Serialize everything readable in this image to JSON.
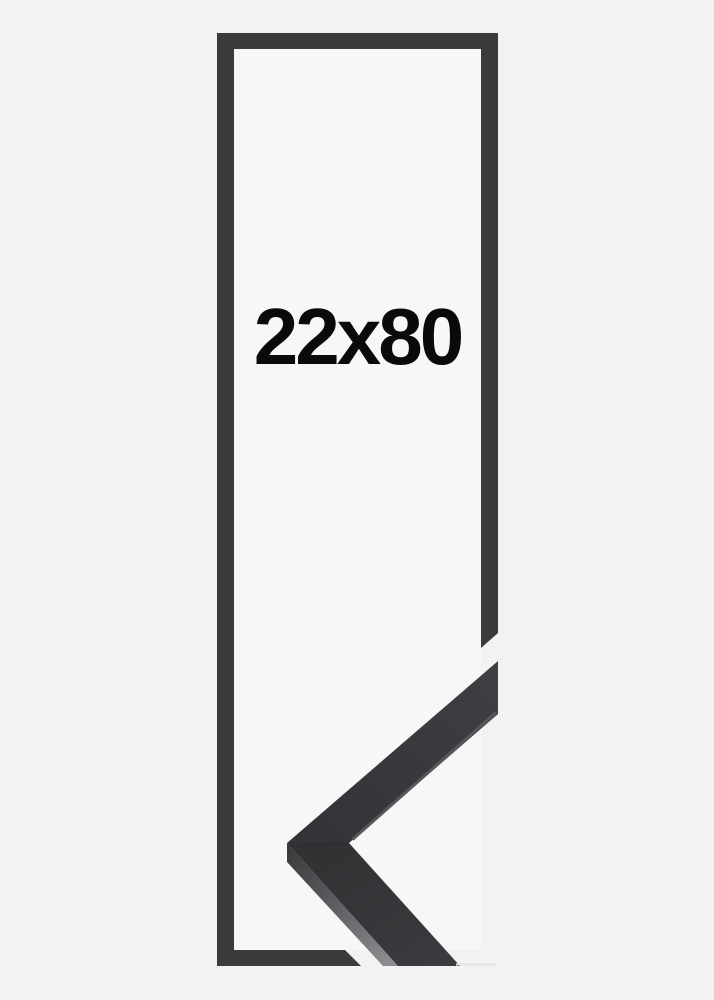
{
  "product": {
    "size_label": "22x80"
  },
  "colors": {
    "background": "#f1f2f2",
    "frame_interior": "#f6f7f7",
    "frame_dark": "#3a3b3d",
    "moulding_face": "#333437",
    "moulding_side_light": "#8d8e91",
    "moulding_edge_stripe": "#55575a",
    "label_text": "#0a0a0a"
  }
}
